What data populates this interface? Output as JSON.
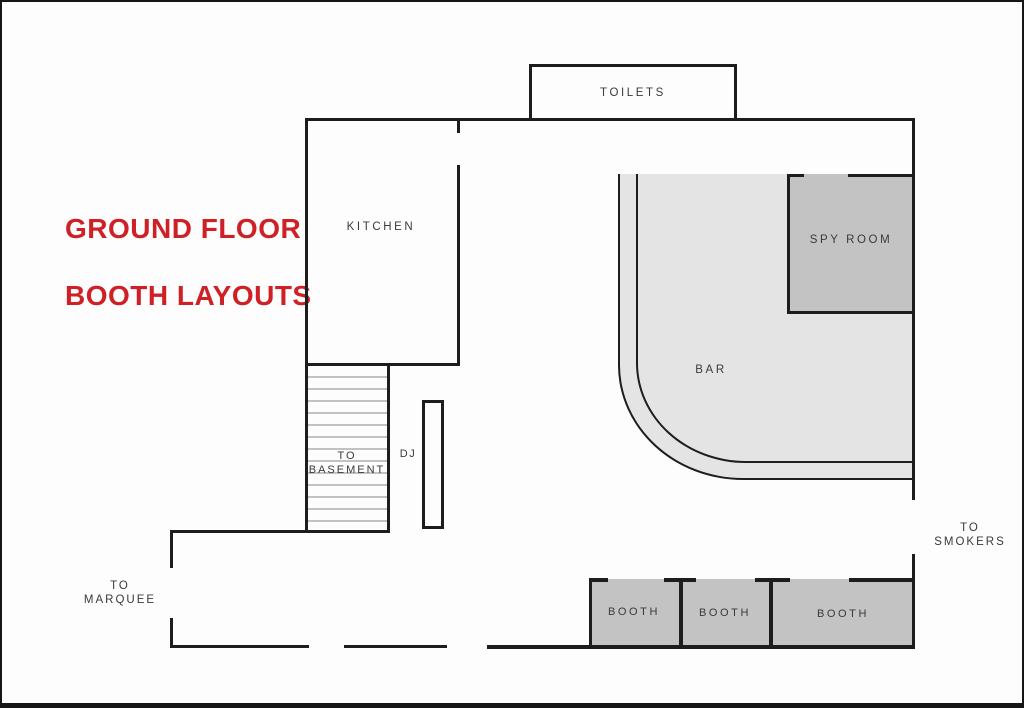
{
  "title": {
    "line1": "GROUND FLOOR",
    "line2": "BOOTH LAYOUTS",
    "color": "#cf2026"
  },
  "rooms": {
    "toilets": "TOILETS",
    "kitchen": "KITCHEN",
    "spy_room": "SPY ROOM",
    "bar": "BAR",
    "dj": "DJ",
    "basement": {
      "line1": "TO",
      "line2": "BASEMENT"
    },
    "smokers": {
      "line1": "TO",
      "line2": "SMOKERS"
    },
    "marquee": {
      "line1": "TO",
      "line2": "MARQUEE"
    },
    "booths": [
      "BOOTH",
      "BOOTH",
      "BOOTH"
    ]
  },
  "colors": {
    "wall": "#1d1d1b",
    "bar_fill": "#e4e4e4",
    "room_fill": "#c3c3c3",
    "stair_stripe": "#c2c2c2",
    "label_text": "#3a3a39",
    "title_red": "#cf2026",
    "background": "#fdfdfd"
  }
}
